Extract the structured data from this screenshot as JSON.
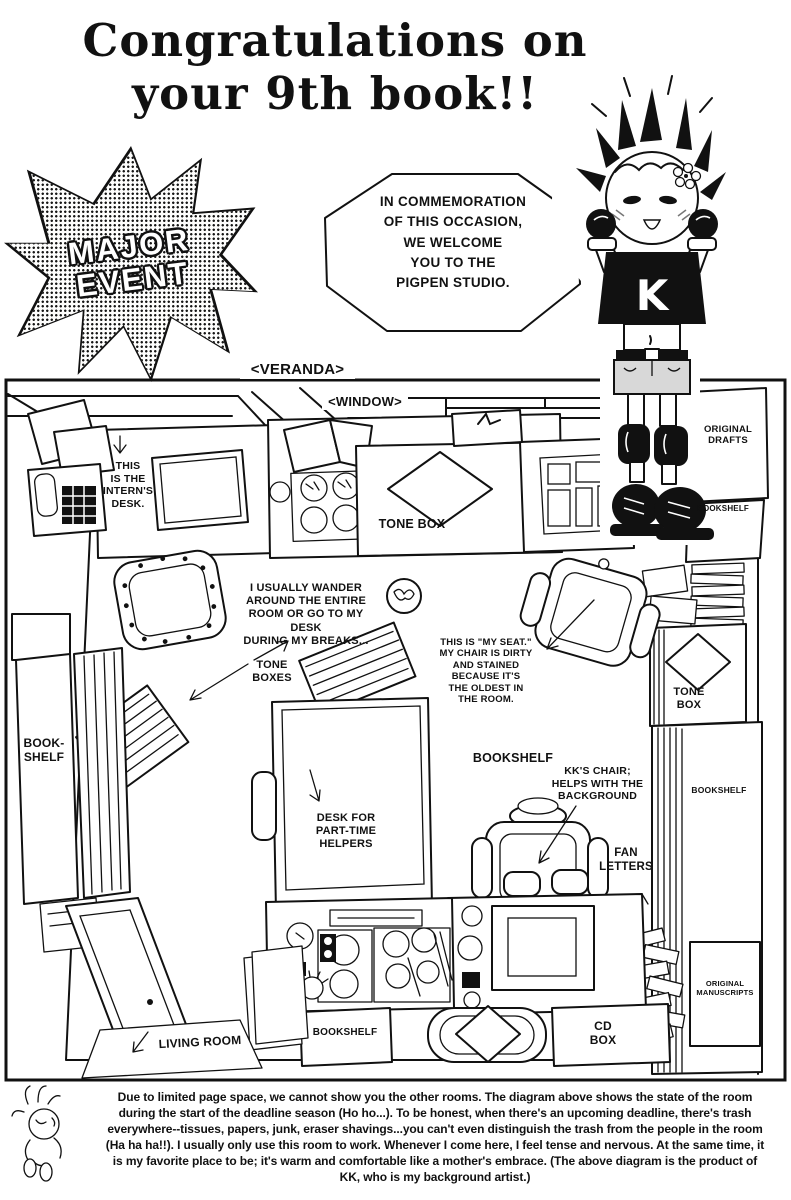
{
  "colors": {
    "ink": "#111111",
    "paper": "#ffffff"
  },
  "header": {
    "title_line1": "Congratulations on",
    "title_line2": "your 9th book!!",
    "burst": {
      "line1": "MAJOR",
      "line2": "EVENT"
    },
    "speech_bubble": "IN COMMEMORATION\nOF THIS OCCASION,\nWE WELCOME\nYOU TO THE\nPIGPEN STUDIO.",
    "character": {
      "shirt_letter": "K"
    }
  },
  "diagram": {
    "labels": {
      "veranda": "<VERANDA>",
      "window": "<WINDOW>",
      "interns_desk": "THIS\nIS THE\nINTERN'S\nDESK.",
      "tone_box_center": "TONE BOX",
      "original_drafts": "ORIGINAL\nDRAFTS",
      "bookshelf_top_right": "BOOKSHELF",
      "wander_note": "I USUALLY WANDER\nAROUND THE ENTIRE\nROOM OR GO TO MY DESK\nDURING MY BREAKS...",
      "tone_boxes": "TONE\nBOXES",
      "my_seat_note": "THIS IS \"MY SEAT.\"\nMY CHAIR IS DIRTY\nAND STAINED\nBECAUSE IT'S\nTHE OLDEST IN\nTHE ROOM.",
      "bookshelf_left": "BOOK-\nSHELF",
      "bookshelf_center": "BOOKSHELF",
      "tone_box_right": "TONE\nBOX",
      "bookshelf_right": "BOOKSHELF",
      "helpers_desk": "DESK FOR\nPART-TIME\nHELPERS",
      "kk_chair": "KK'S CHAIR;\nHELPS WITH THE\nBACKGROUND",
      "fan_letters": "FAN\nLETTERS",
      "original_manuscripts": "ORIGINAL\nMANUSCRIPTS",
      "living_room": "LIVING ROOM",
      "bookshelf_bottom": "BOOKSHELF",
      "cd_box": "CD\nBOX"
    }
  },
  "footer": {
    "paragraph": "Due to limited page space, we cannot show you the other rooms. The diagram above shows the state of the room during the start of the deadline season (Ho ho...). To be honest, when there's an upcoming deadline, there's trash everywhere--tissues, papers, junk, eraser shavings...you can't even distinguish the trash from the people in the room (Ha ha ha!!). I usually only use this room to work. Whenever I come here, I feel tense and nervous. At the same time, it is my favorite place to be; it's warm and comfortable like a mother's embrace. (The above diagram is the product of KK, who is my background artist.)"
  }
}
